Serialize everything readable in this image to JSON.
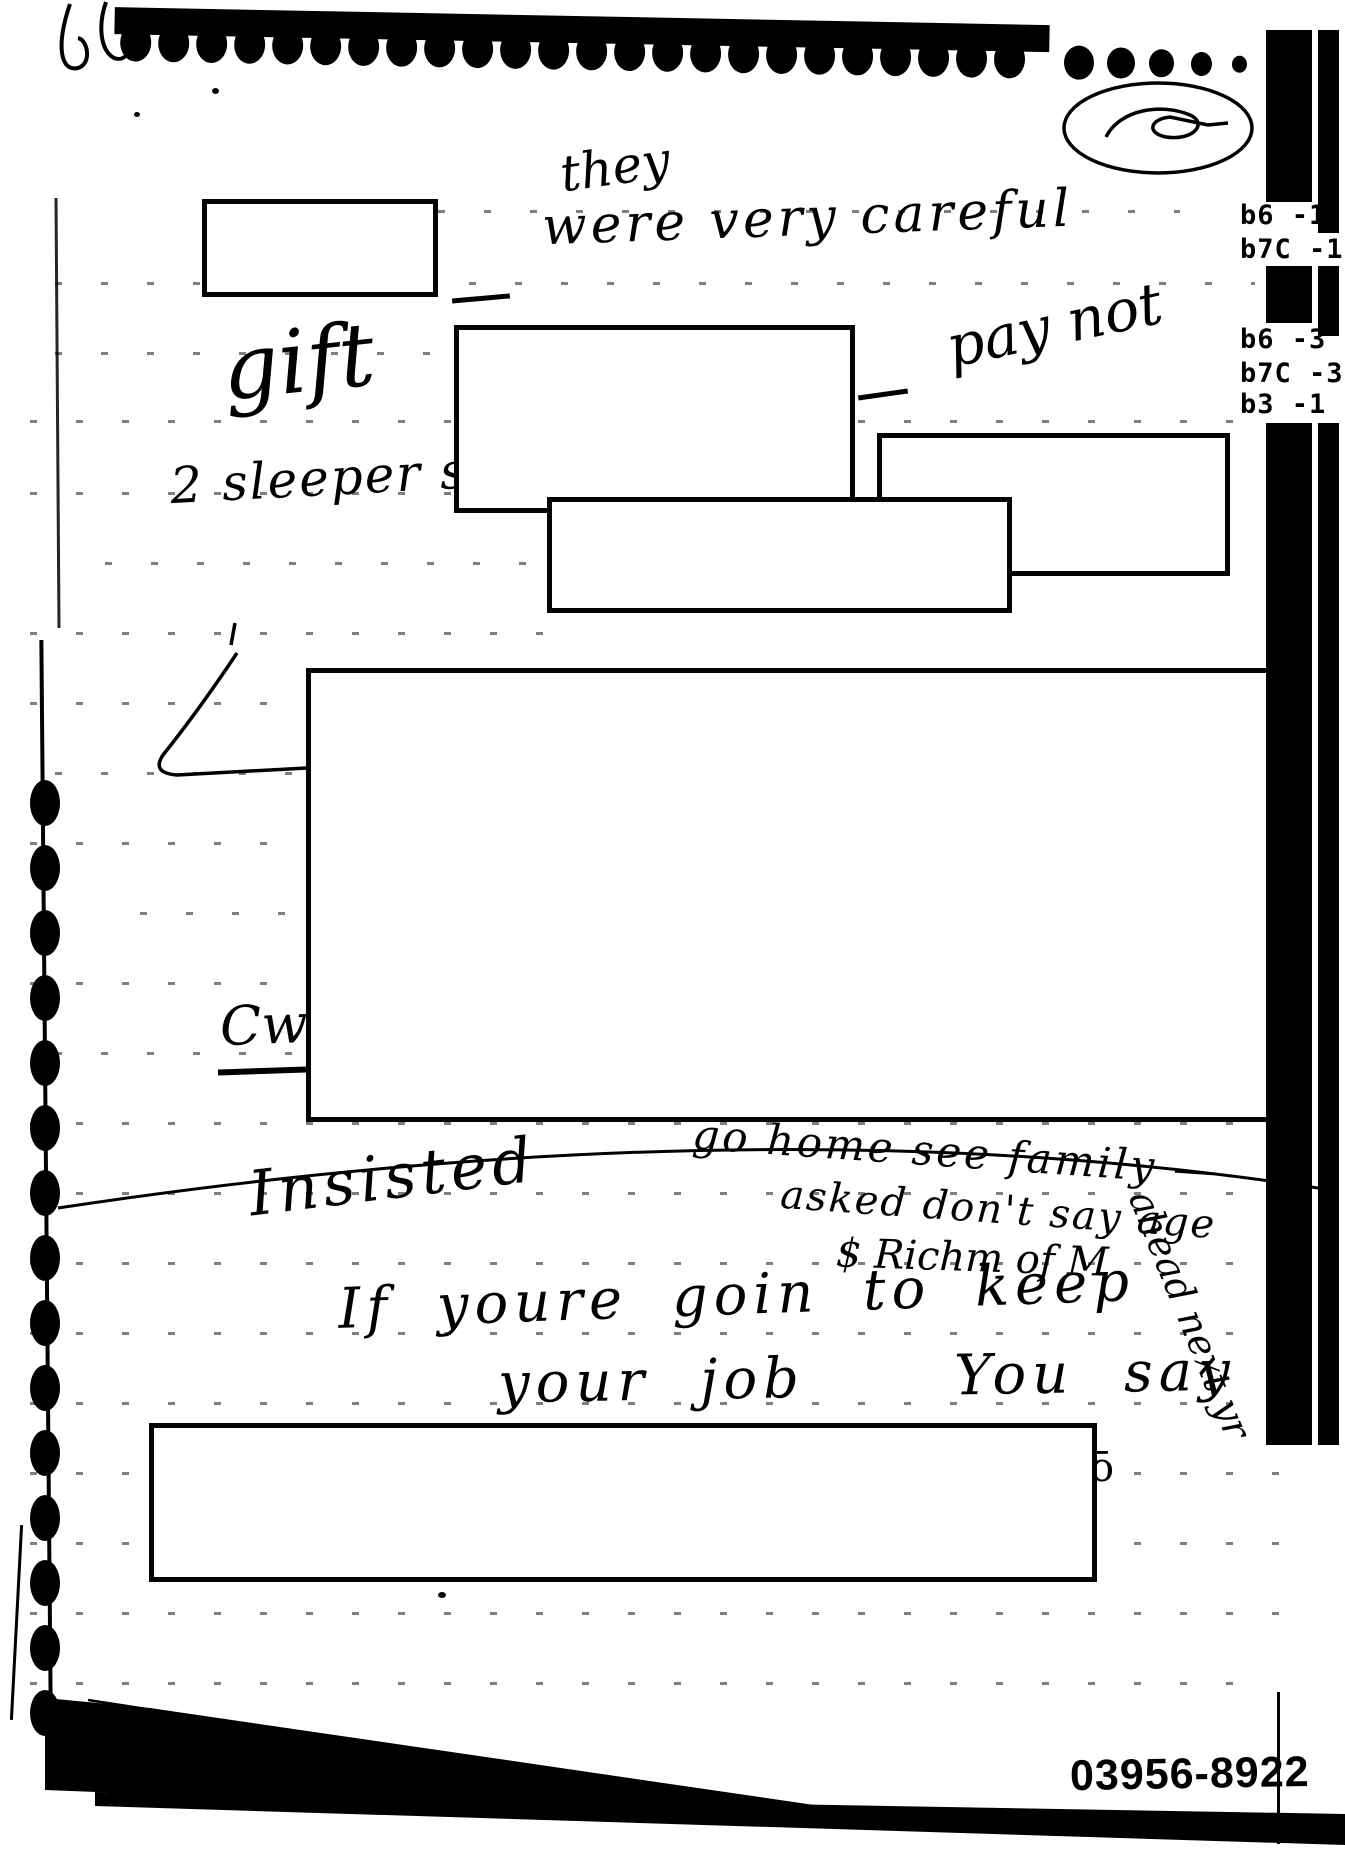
{
  "page": {
    "kind": "Scanned handwritten notebook page with redactions",
    "scribble_circle_text": "72",
    "exemption_codes": [
      "b6 -1",
      "b7C -1",
      "b6 -3",
      "b7C -3",
      "b3 -1"
    ],
    "doc_number": "03956-8922",
    "handwriting": {
      "they": "they",
      "were_very_careful": "were very careful",
      "gift": "gift",
      "pay_not": "pay not",
      "sleeper_space": "2 sleeper space",
      "cure": "Cwe",
      "insisted": "Insisted",
      "go_home": "go home see family —",
      "asked_age": "asked don't say age",
      "dollar_richm": "$ Richm of M",
      "ahead_next": "ahead next yr",
      "if_line1": "If youre goin to keep",
      "if_line2": "your job   You say",
      "o_macron": "ō"
    }
  }
}
